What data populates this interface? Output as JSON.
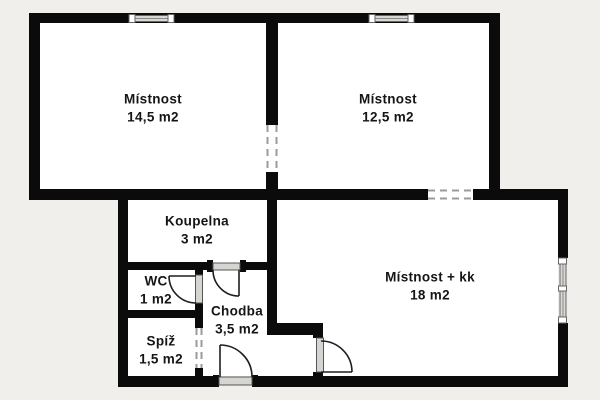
{
  "page": {
    "type": "floor-plan"
  },
  "colors": {
    "wall": "#0b0b0b",
    "background": "#f1efeb",
    "room_fill": "#ffffff",
    "window_fill": "#d9d8d4",
    "opening_dash": "#9b9b9b",
    "label_text": "#151515"
  },
  "rooms": {
    "room1": {
      "name": "Místnost",
      "area": "14,5 m2"
    },
    "room2": {
      "name": "Místnost",
      "area": "12,5 m2"
    },
    "bathroom": {
      "name": "Koupelna",
      "area": "3 m2"
    },
    "wc": {
      "name": "WC",
      "area": "1 m2"
    },
    "hallway": {
      "name": "Chodba",
      "area": "3,5 m2"
    },
    "pantry": {
      "name": "Spíž",
      "area": "1,5 m2"
    },
    "living": {
      "name": "Místnost + kk",
      "area": "18 m2"
    }
  }
}
